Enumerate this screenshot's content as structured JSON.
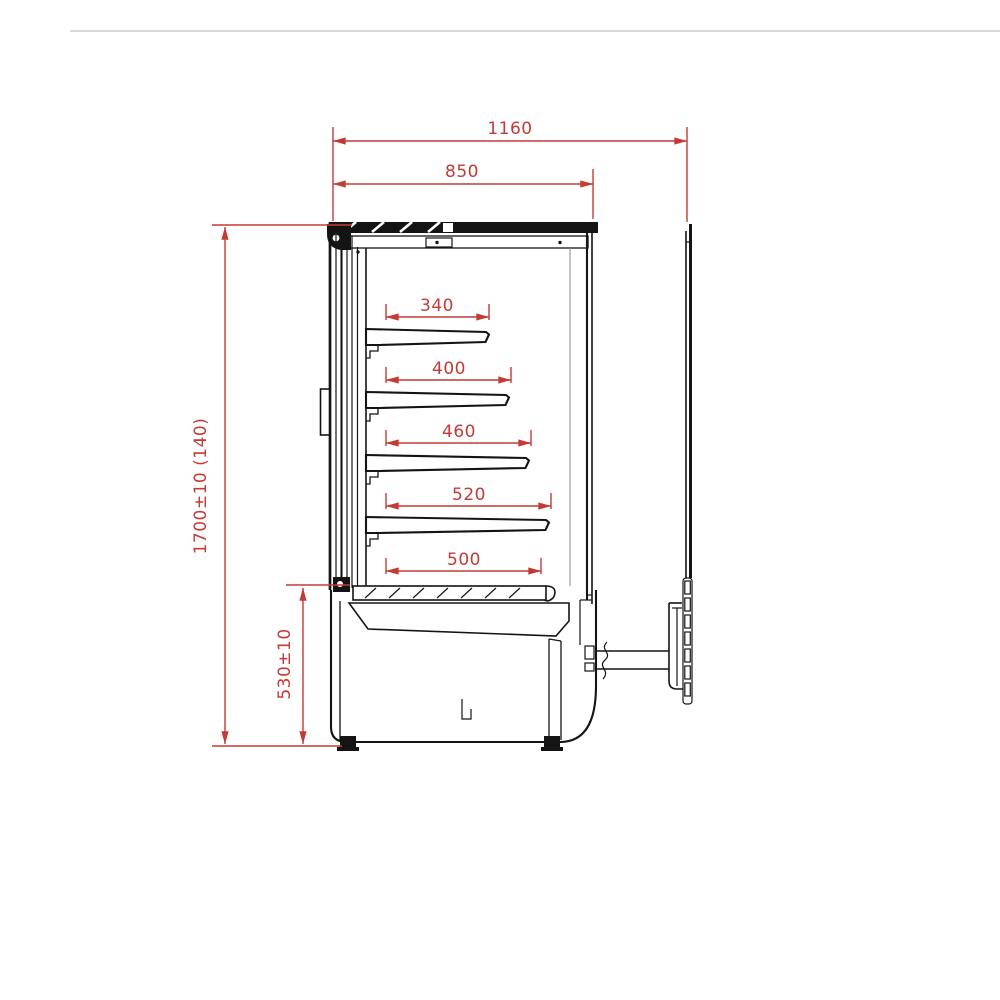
{
  "page": {
    "background": "#ffffff",
    "top_divider_color": "#d9d9d9"
  },
  "drawing": {
    "subject": "refrigerated-display-cabinet-side-elevation",
    "line_color": "#141414",
    "dimension_color": "#c43a36",
    "dimensions": {
      "overall_width_top": "1160",
      "body_width": "850",
      "shelf_1_depth": "340",
      "shelf_2_depth": "400",
      "shelf_3_depth": "460",
      "shelf_4_depth": "520",
      "base_deck_depth": "500",
      "overall_height": "1700±10 (140)",
      "base_height": "530±10"
    }
  }
}
